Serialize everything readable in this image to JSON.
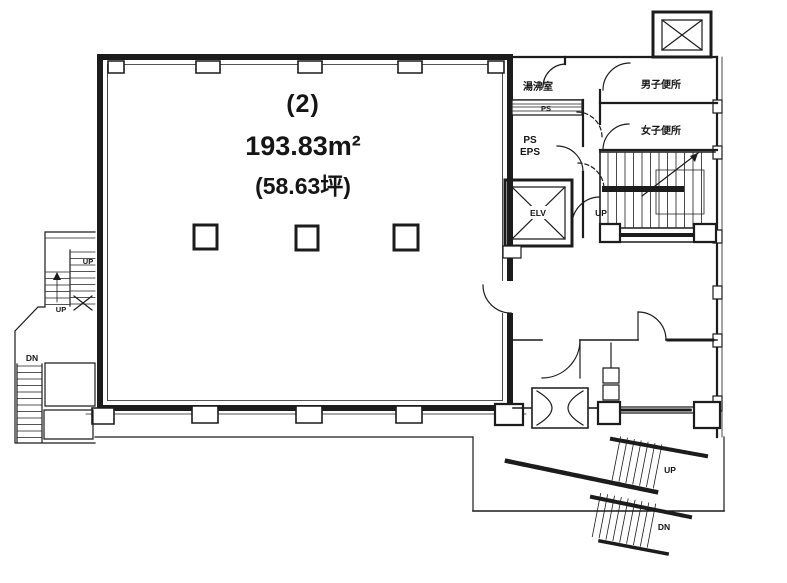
{
  "plan": {
    "main_room": {
      "number": "(2)",
      "area_m2": "193.83m²",
      "area_tsubo": "(58.63坪)"
    },
    "rooms": {
      "kitchenette": "湯沸室",
      "mens_toilet": "男子便所",
      "womens_toilet": "女子便所",
      "pipe_shaft": "PS",
      "ps_line1": "PS",
      "ps_line2": "EPS",
      "elevator": "ELV"
    },
    "labels": {
      "up_main_stair": "UP",
      "up_left_upper": "UP",
      "up_left_lower": "UP",
      "dn_left": "DN",
      "up_bottom_right": "UP",
      "dn_bottom_right": "DN"
    },
    "colors": {
      "wall": "#1c1c1c",
      "background": "#ffffff"
    }
  }
}
